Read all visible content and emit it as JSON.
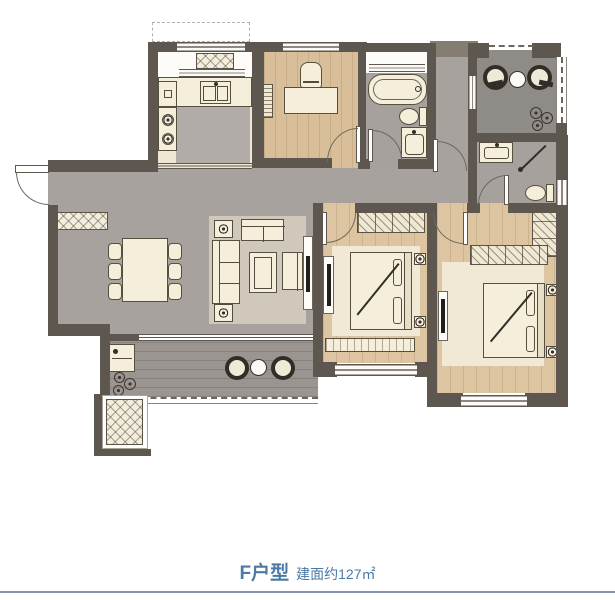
{
  "caption": {
    "title": "F户型",
    "subtitle": "建面约127㎡"
  },
  "colors": {
    "wall": "#5d5750",
    "floor_gray": "#a8a29e",
    "wood": "#dcc5a0",
    "wood_study": "#d8bf99",
    "rug": "#f1e9d6",
    "bath_floor": "#a6a19c",
    "balcony_top": "#8f8c88",
    "balcony_south": "#9a9591",
    "furniture": "#f4eeda",
    "outline": "#55503f",
    "title_color": "#4c7aa4",
    "divider_color": "#8296aa"
  },
  "rooms": [
    "kitchen",
    "study",
    "bathroom-1",
    "hallway",
    "utility-corridor",
    "leisure-balcony",
    "bathroom-2",
    "living-dining-room",
    "bedroom-1",
    "master-bedroom",
    "south-balcony",
    "flue-platform",
    "entry"
  ],
  "fixtures": [
    "kitchen-sink",
    "stove",
    "kitchen-cabinet",
    "appliance-platform",
    "desk",
    "desk-chair",
    "bookshelf",
    "bathtub",
    "toilet",
    "wash-basin",
    "shower-arrow",
    "lounge-chair",
    "round-table",
    "potted-plant",
    "dining-table",
    "dining-chair",
    "sofa-3-seat",
    "loveseat",
    "coffee-table",
    "armchair",
    "side-table",
    "tv-cabinet",
    "shoe-cabinet",
    "wardrobe",
    "double-bed",
    "nightstand",
    "window-seat",
    "entry-door",
    "interior-door",
    "sliding-door",
    "window",
    "railing"
  ]
}
